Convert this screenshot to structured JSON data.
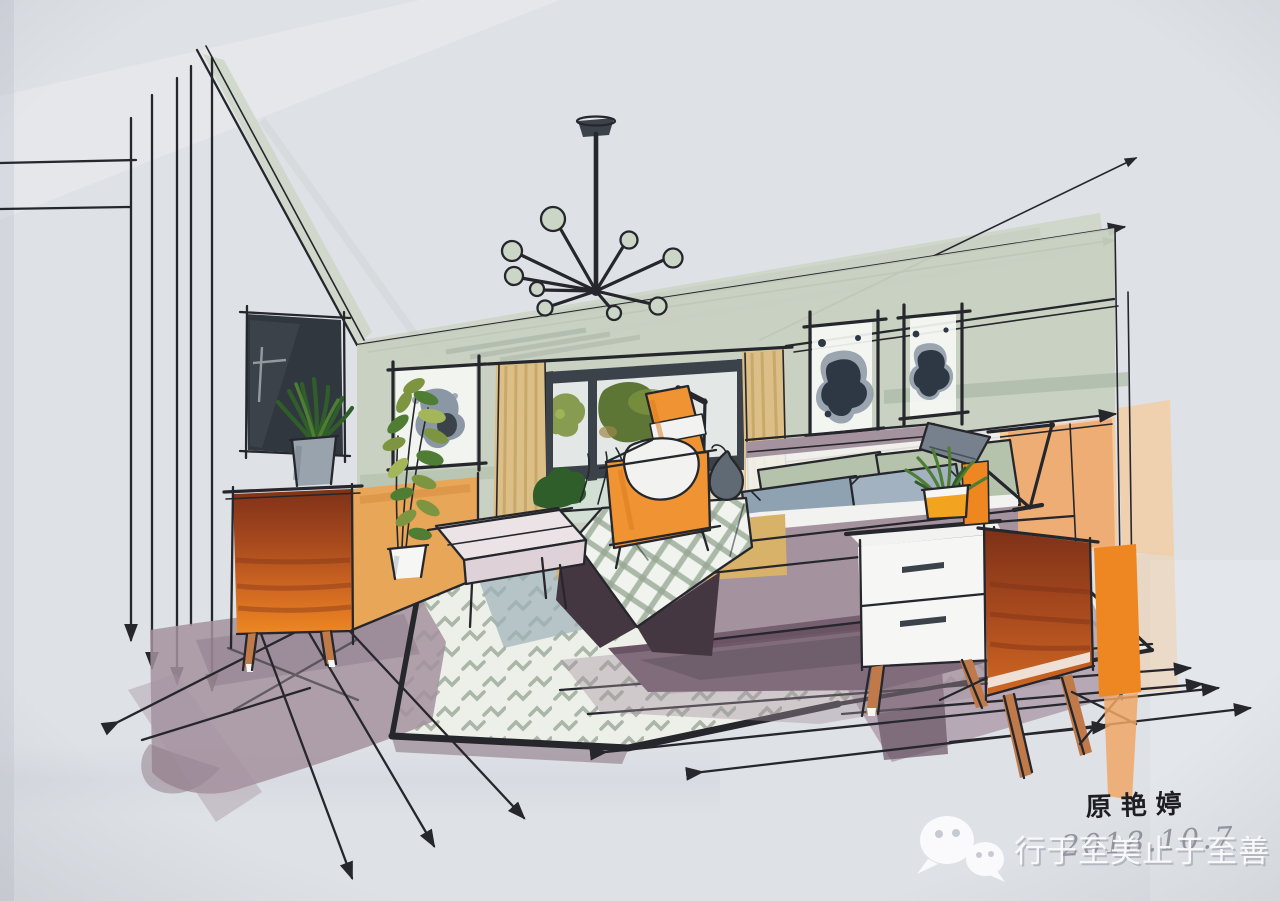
{
  "artwork": {
    "description": "Hand-drawn marker rendering of a bedroom interior in two-point perspective",
    "signature": "原艳婷",
    "handwritten_date": "2018.10.7",
    "watermark": {
      "icon": "wechat-icon",
      "text": "行于至美止于至善"
    }
  },
  "scene": {
    "objects": [
      "sputnik chandelier",
      "wall-mounted dark TV panel",
      "orange mid-century dresser",
      "spiky plant in gray pot",
      "tall leafy plant in white pot",
      "framed ink-blot art on left wall",
      "window with tan striped curtains",
      "green shrub on windowsill",
      "orange high-back armchair",
      "black floor reading lamp",
      "bed with sage and blue-gray pillows",
      "checked plaid throw",
      "khaki blanket",
      "upholstered bench",
      "two framed ink-blot artworks above bed",
      "white two-drawer nightstand",
      "black articulated desk lamp",
      "succulent in orange cube pot",
      "orange side cabinet",
      "chevron-pattern area rug",
      "wood plank floor"
    ]
  },
  "palette": {
    "paper": "#dee1e6",
    "paperLight": "#ebedef",
    "paperShade": "#c6cad2",
    "ink": "#26272c",
    "sageBand": "#ccd6c6",
    "sageWall": "#c6d0c0",
    "sageDark": "#a9b7a4",
    "oliveLeaf": "#7d9440",
    "oliveDark": "#55702c",
    "leafBright": "#a3b659",
    "leafDark": "#2f5e2b",
    "leafMid": "#4e7d33",
    "moss": "#9c8848",
    "curtain": "#dcbf86",
    "curtainStripe": "#bfa060",
    "slate": "#3b424a",
    "navy": "#2e3845",
    "grayBlob": "#8b97a4",
    "tvDark": "#30373f",
    "tvSheen": "#cfd6da",
    "paneLight": "#e3e8e6",
    "mintSill": "#d9e8df",
    "burntTop": "#7e3118",
    "burntMid": "#a84a1e",
    "burntLow": "#d06822",
    "orangeBright": "#ee8722",
    "orangeChair": "#f09433",
    "orangeDeep": "#d9781c",
    "orangeSide": "#e8a658",
    "orangeSideDeep": "#d08838",
    "orangeSoft": "#f0a766",
    "orangePot": "#f2a31f",
    "peach": "#f2cda4",
    "peachDeep": "#eda05f",
    "khaki": "#d9b26a",
    "mauve": "#a5929f",
    "mauveDeep": "#8d7987",
    "plum": "#6a5463",
    "plumDark": "#453742",
    "pillowBlue": "#8fa2b2",
    "pillowBlue2": "#a2b2c1",
    "pillowSage": "#b5c2ac",
    "duvet": "#f2f3f0",
    "white": "#f6f7f5",
    "benchTop": "#ece3e6",
    "benchFront": "#ded2d8",
    "rugBase": "#edefe9",
    "rugMark": "#a3b1a0",
    "plaidBase": "#f1f3ee",
    "plaidGrid": "#9aaa97",
    "wood": "#c07a4a",
    "grayPot": "#99a3ad",
    "grayPotShade": "#7b8791",
    "lampShade": "#76818d",
    "teardrop": "#5f6a74",
    "shadowBlue": "#9eb2b8",
    "hatchGray": "#9aa49c",
    "wmWhite": "#fbfbfd",
    "wmShadow": "#8f939e",
    "signatureInk": "#1d1d22",
    "dateInk": "#4a4a57"
  }
}
